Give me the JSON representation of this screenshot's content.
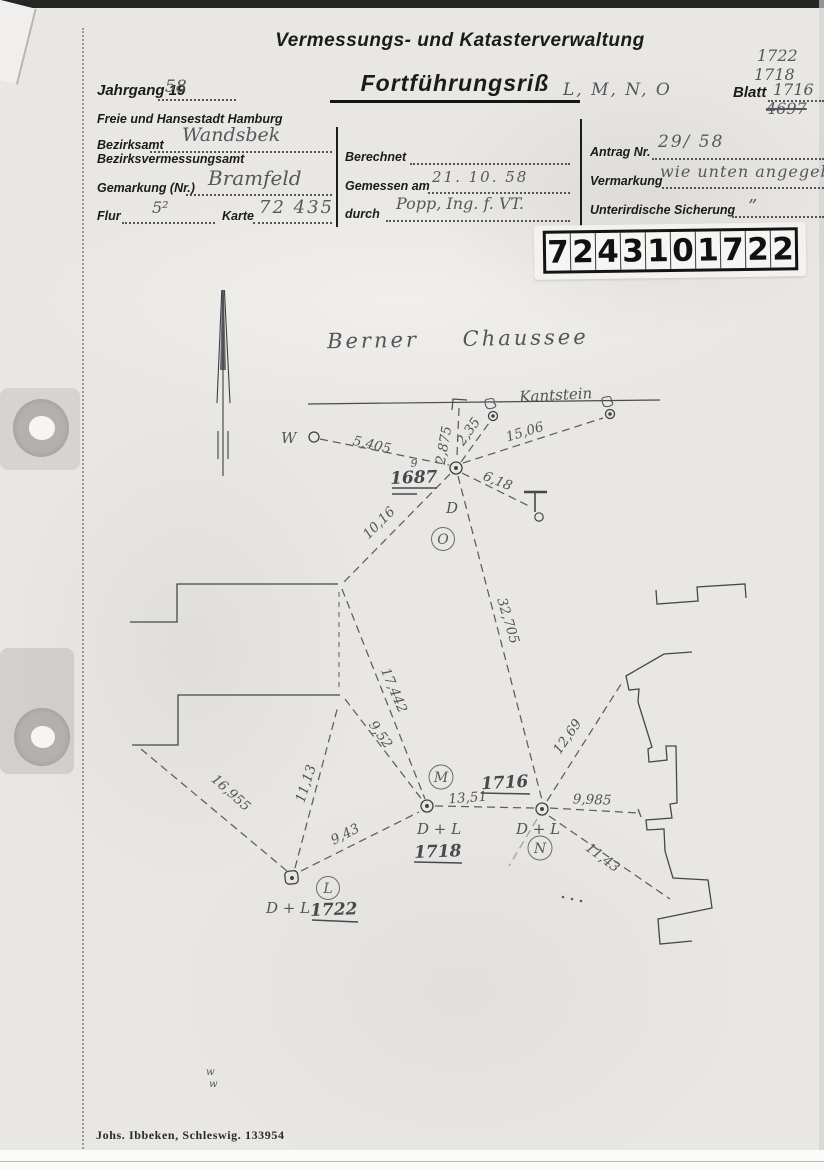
{
  "header": {
    "agency_title": "Vermessungs- und Katasterverwaltung",
    "doc_title": "Fortführungsriß",
    "doc_title_sections": "L, M, N, O",
    "jahrgang_label": "Jahrgang 19",
    "jahrgang_value": "58",
    "city_line": "Freie und Hansestadt Hamburg",
    "blatt": {
      "label": "Blatt",
      "stacked": [
        "1722",
        "1718"
      ],
      "value": "1716",
      "crossed": "4697"
    }
  },
  "form": {
    "left": {
      "bezirksamt_label": "Bezirksamt",
      "bezirksamt_value": "Wandsbek",
      "bezirksvermessungsamt_label": "Bezirksvermessungsamt",
      "gemarkung_label": "Gemarkung (Nr.)",
      "gemarkung_value": "Bramfeld",
      "flur_label": "Flur",
      "flur_value": "5²",
      "karte_label": "Karte",
      "karte_value": "72 435"
    },
    "middle": {
      "berechnet_label": "Berechnet",
      "gemessen_label": "Gemessen am",
      "gemessen_value": "21.  10.  58",
      "durch_label": "durch",
      "durch_value": "Popp, Ing. f. VT."
    },
    "right": {
      "antrag_label": "Antrag Nr.",
      "antrag_value": "29/ 58",
      "vermarkung_label": "Vermarkung",
      "vermarkung_value": "wie unten angegeben",
      "sicherung_label": "Unterirdische Sicherung",
      "sicherung_value": "”"
    }
  },
  "stamp": {
    "digits": [
      "7",
      "2",
      "4",
      "3",
      "1",
      "0",
      "1",
      "7",
      "2",
      "2"
    ]
  },
  "sketch": {
    "street_name": "Berner Chaussee",
    "curb_label": "Kantstein",
    "west_label": "W",
    "point_letter": "D",
    "marker_code": "D + L",
    "points": {
      "o": "1687",
      "o_correction": "9",
      "n": "1716",
      "m": "1718",
      "l": "1722"
    },
    "sections": {
      "l": "L",
      "m": "M",
      "n": "N",
      "o": "O"
    },
    "measurements": [
      "5,405",
      "2,875",
      "2,35",
      "15,06",
      "6,18",
      "10,16",
      "32,705",
      "17,442",
      "9,52",
      "11,13",
      "16,955",
      "9,43",
      "13,51",
      "9,985",
      "12,69",
      "11,43"
    ]
  },
  "footer": {
    "printer_note": "Johs. Ibbeken, Schleswig.  133954"
  }
}
